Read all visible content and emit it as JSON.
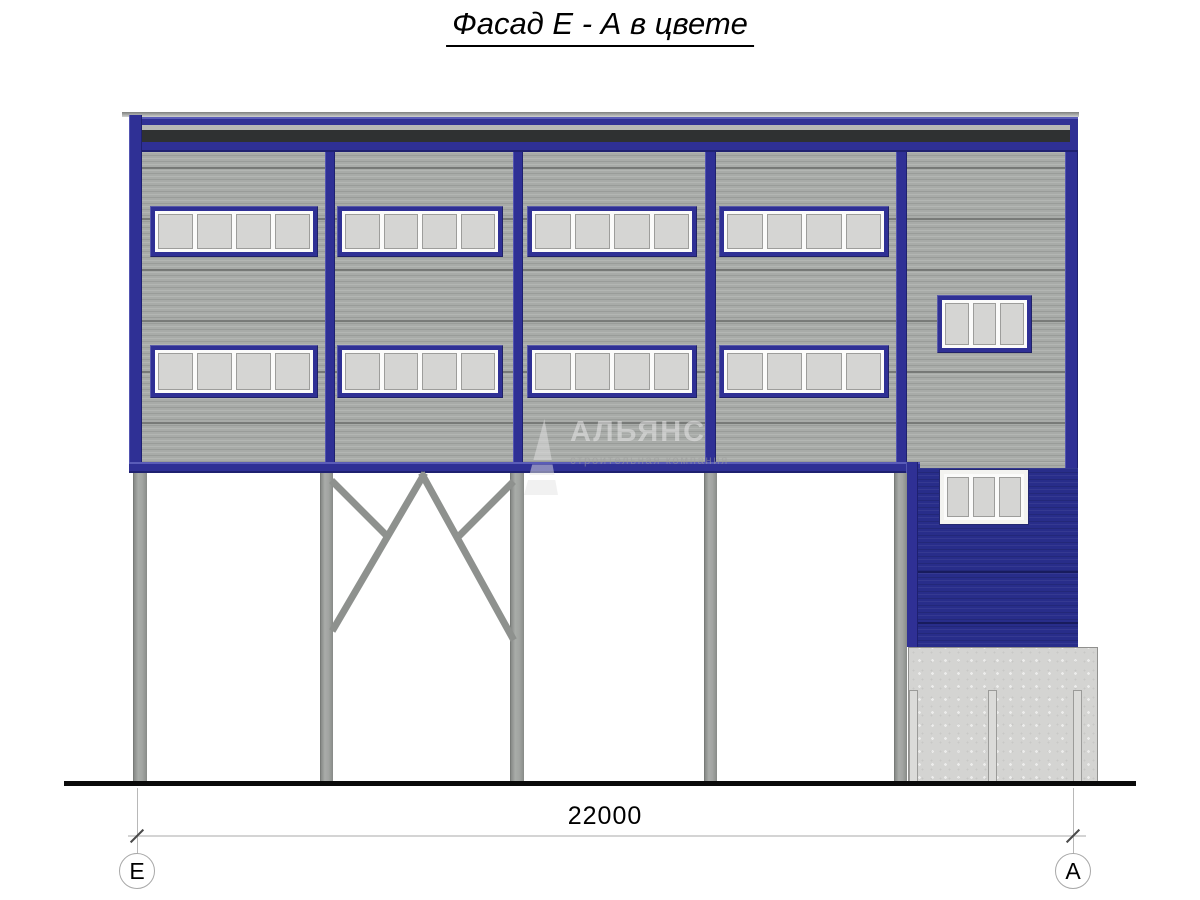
{
  "page": {
    "title": "Фасад Е - А в цвете"
  },
  "dimension": {
    "label": "22000"
  },
  "axis_markers": {
    "left": "Е",
    "right": "А"
  },
  "watermark": {
    "company": "АЛЬЯНС",
    "tagline": "строительная компания"
  },
  "colors": {
    "frame-blue": "#2f3095",
    "lower-wall-blue": "#282d8a",
    "siding-gray": "#a8aba8",
    "joint-gray": "#6e716e",
    "dark-stripe": "#2f3132",
    "light-stripe": "#b5b7b5",
    "concrete-gray": "#d4d4d2",
    "pane-gray": "#d5d5d3"
  }
}
